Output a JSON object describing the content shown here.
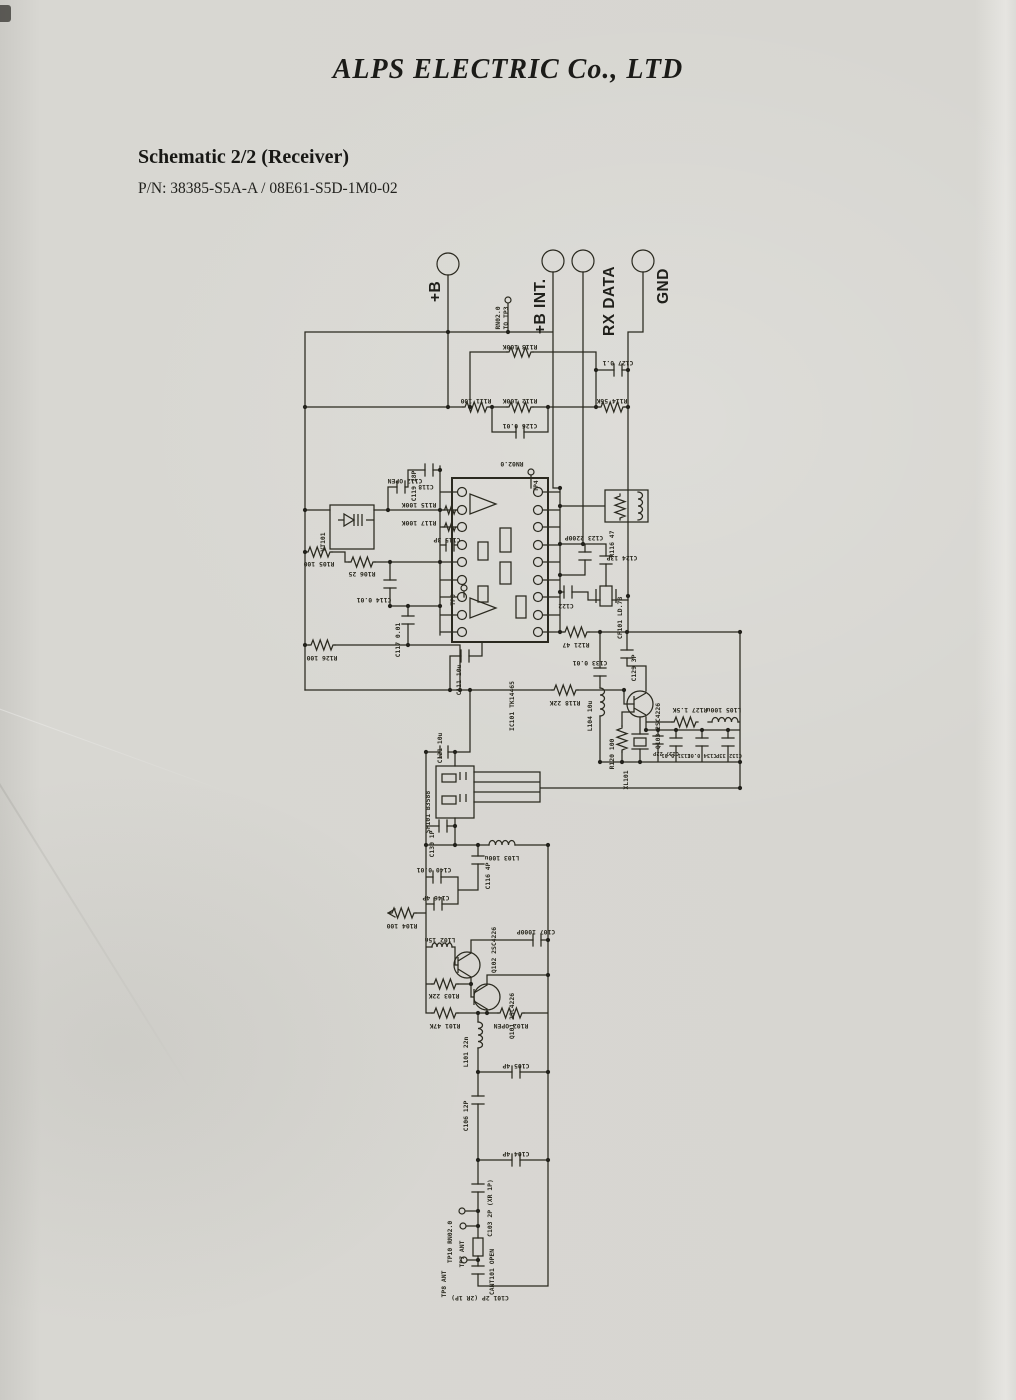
{
  "page": {
    "company": "ALPS ELECTRIC Co., LTD",
    "schematic_title": "Schematic 2/2 (Receiver)",
    "part_number": "P/N: 38385-S5A-A / 08E61-S5D-1M0-02"
  },
  "connectors": [
    {
      "label": "+B"
    },
    {
      "label": "+B INT."
    },
    {
      "label": "RX DATA"
    },
    {
      "label": "GND"
    }
  ],
  "schematic": {
    "labels": [
      "R113 100K",
      "R111 100",
      "R112 100K",
      "R114 56K",
      "C127 0.1",
      "C126 0.01",
      "C112 OPEN",
      "VT101",
      "R105 100",
      "R106 25",
      "C114 0.01",
      "C117 0.01",
      "R126 100",
      "C119 18P",
      "RN02.0",
      "TP4",
      "C118",
      "R115 100K",
      "R117 100K",
      "C115 3P",
      "TP6",
      "IC101 TK14465",
      "C111 10u",
      "R116 47",
      "C123 2200P",
      "C122",
      "C124 13P",
      "CF101 LD.7B",
      "R121 47",
      "R118 22K",
      "C129 3P",
      "C133 0.01",
      "L104 10u",
      "Q103 2SC4226",
      "C137 22P",
      "R120 100",
      "XL101",
      "R127 1.5K",
      "L105 100u",
      "C131 0.01",
      "C134 0.01",
      "C132 33P",
      "C121 10u",
      "SF101 B3588",
      "C130 1P",
      "L103 100u",
      "C116 4P",
      "C140 0.01",
      "C146 4P",
      "L102 15n",
      "Q102 2SC4226",
      "C107 1000P",
      "R104 100",
      "R103 22K",
      "Q101 2SC4226",
      "R101 47K",
      "R102 OPEN",
      "L101 22n",
      "C105 4P",
      "C106 12P",
      "C104 4P",
      "C103 2P (XR 1P)",
      "TP10 RN02.0",
      "TP7 ANT",
      "CANT101 OPEN",
      "TP8 ANT",
      "C101 2P (2R 1P)",
      "TO TP3"
    ]
  }
}
